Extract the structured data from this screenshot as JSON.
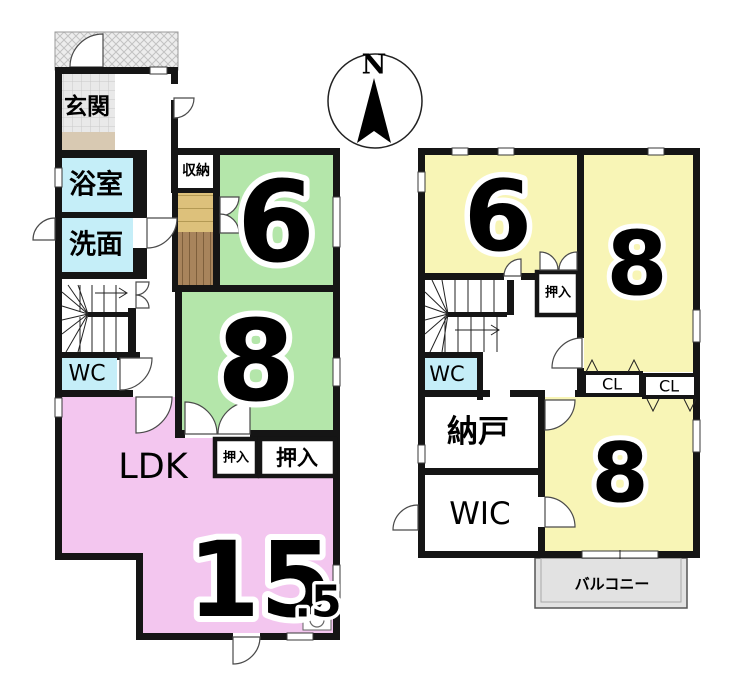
{
  "title": "2-story house floor plan",
  "colors": {
    "wall": "#151515",
    "room_green": "#b4e6aa",
    "room_yellow": "#f8f5b6",
    "room_pink": "#f3c6ef",
    "room_cyan": "#c5eef8",
    "genkan_beige": "#d8c9b2",
    "step_tan": "#ddc17b",
    "wood_brown": "#a8845c",
    "porch_gray": "#ededed",
    "balcony_gray": "#e2e2e2"
  },
  "floor1": {
    "entrance_label": "玄関",
    "bath_label": "浴室",
    "washroom_label": "洗面",
    "storage_label": "収納",
    "wc_label": "WC",
    "room6_size": "6",
    "room8_size": "8",
    "closet_small_label": "押入",
    "closet_large_label": "押入",
    "ldk_label": "LDK",
    "ldk_size": "15",
    "ldk_size_decimal": ".5"
  },
  "floor2": {
    "room6_size": "6",
    "room8_top_size": "8",
    "room8_bottom_size": "8",
    "closet_label": "押入",
    "wc_label": "WC",
    "cl_left_label": "CL",
    "cl_right_label": "CL",
    "storeroom_label": "納戸",
    "wic_label": "WIC",
    "balcony_label": "バルコニー"
  },
  "compass": {
    "north_label": "N"
  }
}
